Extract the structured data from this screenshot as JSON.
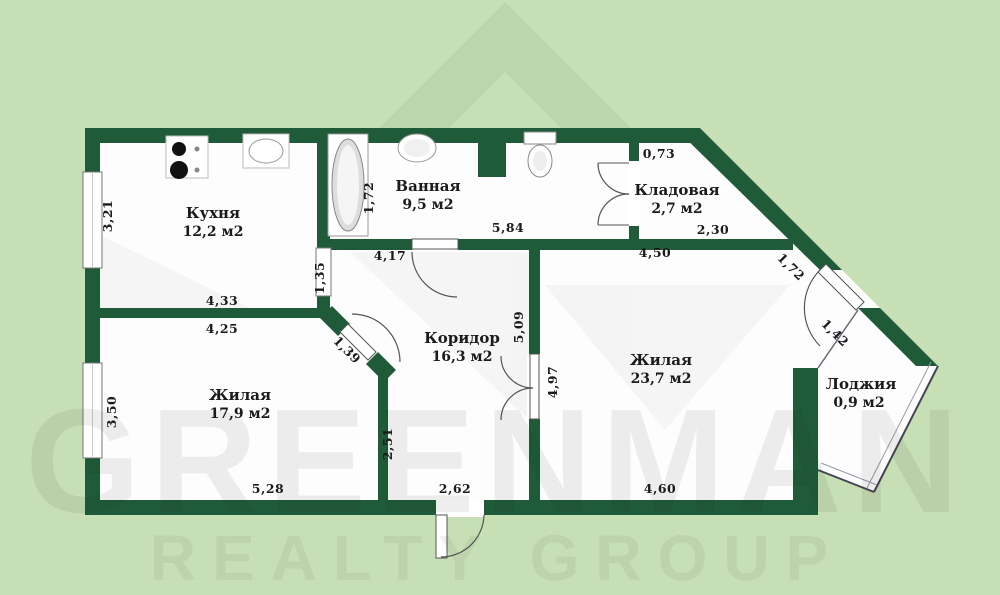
{
  "watermark": {
    "brand": "GREENMAN",
    "tagline": "REALTY GROUP"
  },
  "colors": {
    "background": "#c7dfb4",
    "watermark_roof": "#bdd5ab",
    "wall": "#1f5b38",
    "floor": "#fdfdfd"
  },
  "rooms": [
    {
      "id": "kitchen",
      "name": "Кухня",
      "area": "12,2 м2"
    },
    {
      "id": "bathroom",
      "name": "Ванная",
      "area": "9,5 м2"
    },
    {
      "id": "storage",
      "name": "Кладовая",
      "area": "2,7 м2"
    },
    {
      "id": "corridor",
      "name": "Коридор",
      "area": "16,3 м2"
    },
    {
      "id": "living-1",
      "name": "Жилая",
      "area": "17,9 м2"
    },
    {
      "id": "living-2",
      "name": "Жилая",
      "area": "23,7 м2"
    },
    {
      "id": "loggia",
      "name": "Лоджия",
      "area": "0,9 м2"
    }
  ],
  "dims": [
    {
      "id": "kitchen-left",
      "value": "3,21"
    },
    {
      "id": "kitchen-bottom",
      "value": "4,33"
    },
    {
      "id": "living1-top",
      "value": "4,25"
    },
    {
      "id": "living1-left",
      "value": "3,50"
    },
    {
      "id": "living1-bottom",
      "value": "5,28"
    },
    {
      "id": "living1-right",
      "value": "2,51"
    },
    {
      "id": "living1-door",
      "value": "1,39"
    },
    {
      "id": "kitchen-right",
      "value": "1,35"
    },
    {
      "id": "bath-door-wall",
      "value": "4,17"
    },
    {
      "id": "bath-left",
      "value": "1,72"
    },
    {
      "id": "bath-bottom",
      "value": "5,84"
    },
    {
      "id": "entrance",
      "value": "2,62"
    },
    {
      "id": "corridor-right",
      "value": "5,09"
    },
    {
      "id": "living2-left",
      "value": "4,97"
    },
    {
      "id": "living2-top",
      "value": "4,50"
    },
    {
      "id": "storage-bottom",
      "value": "2,30"
    },
    {
      "id": "storage-top",
      "value": "0,73"
    },
    {
      "id": "diagonal-wall",
      "value": "1,72"
    },
    {
      "id": "loggia-door",
      "value": "1,42"
    },
    {
      "id": "living2-bottom",
      "value": "4,60"
    }
  ]
}
